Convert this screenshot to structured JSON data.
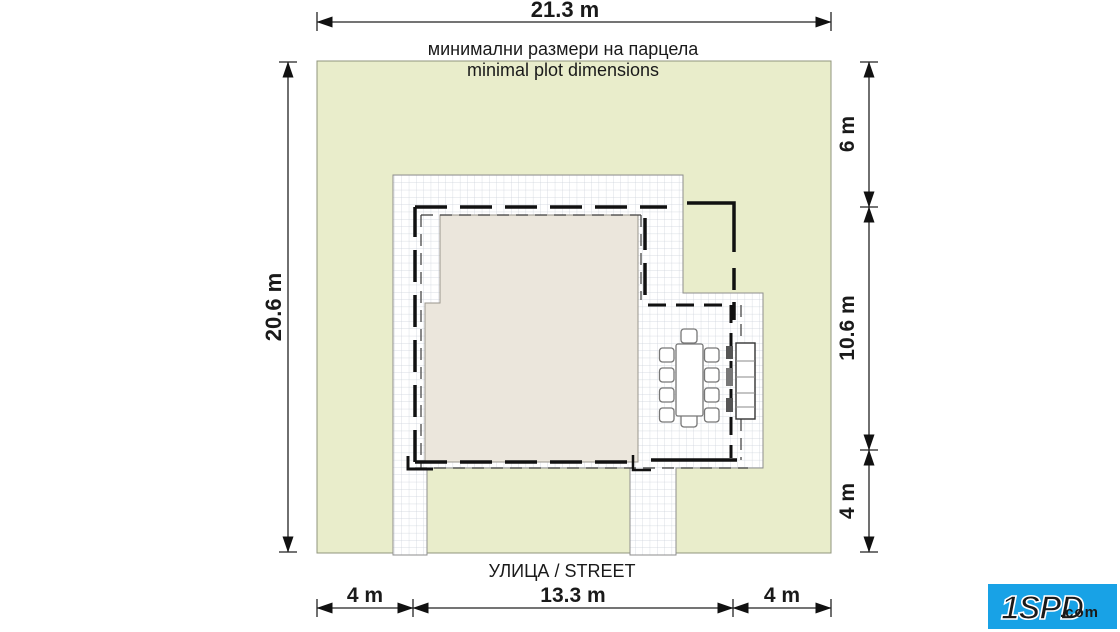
{
  "header": {
    "top_dimension": "21.3 m",
    "title_bg": "минимални размери на парцела",
    "title_en": "minimal plot dimensions"
  },
  "dimensions": {
    "left": "20.6 m",
    "right_top": "6 m",
    "right_middle": "10.6 m",
    "right_bottom": "4 m",
    "bottom_left": "4 m",
    "bottom_center": "13.3 m",
    "bottom_right": "4 m"
  },
  "street": {
    "label": "УЛИЦА / STREET"
  },
  "logo": {
    "main": "1SPD",
    "suffix": ".com"
  },
  "colors": {
    "plot_green": "#e9edcb",
    "house_fill": "#ebe6dc",
    "grid_line": "#ccd2da",
    "drawing_line": "#111111",
    "logo_blue": "#18a2e6"
  }
}
